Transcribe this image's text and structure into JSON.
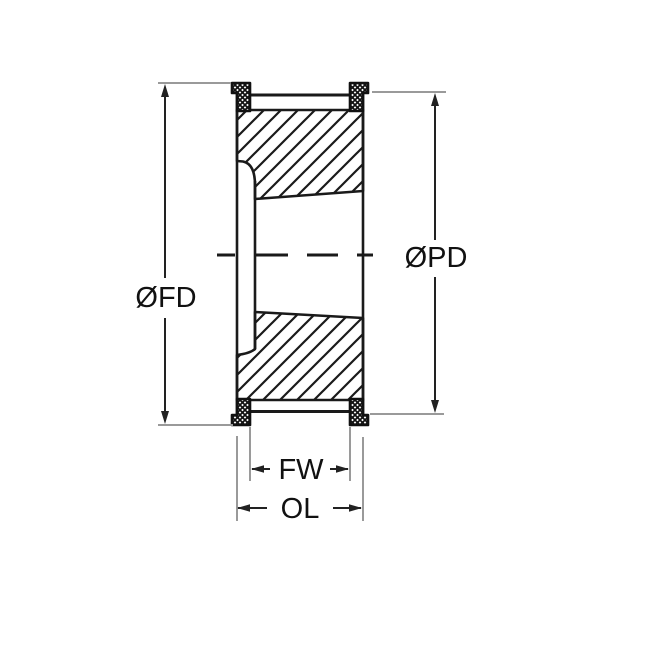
{
  "drawing": {
    "type": "technical-cross-section",
    "subject": "flanged timing pulley with tapered bore",
    "labels": {
      "flange_diameter": "ØFD",
      "pitch_diameter": "ØPD",
      "face_width": "FW",
      "overall_length": "OL"
    },
    "colors": {
      "outline": "#1a1a1a",
      "hatch": "#1a1a1a",
      "extension_line": "#9a9a9a",
      "dimension_line": "#222222",
      "background": "#ffffff"
    }
  }
}
